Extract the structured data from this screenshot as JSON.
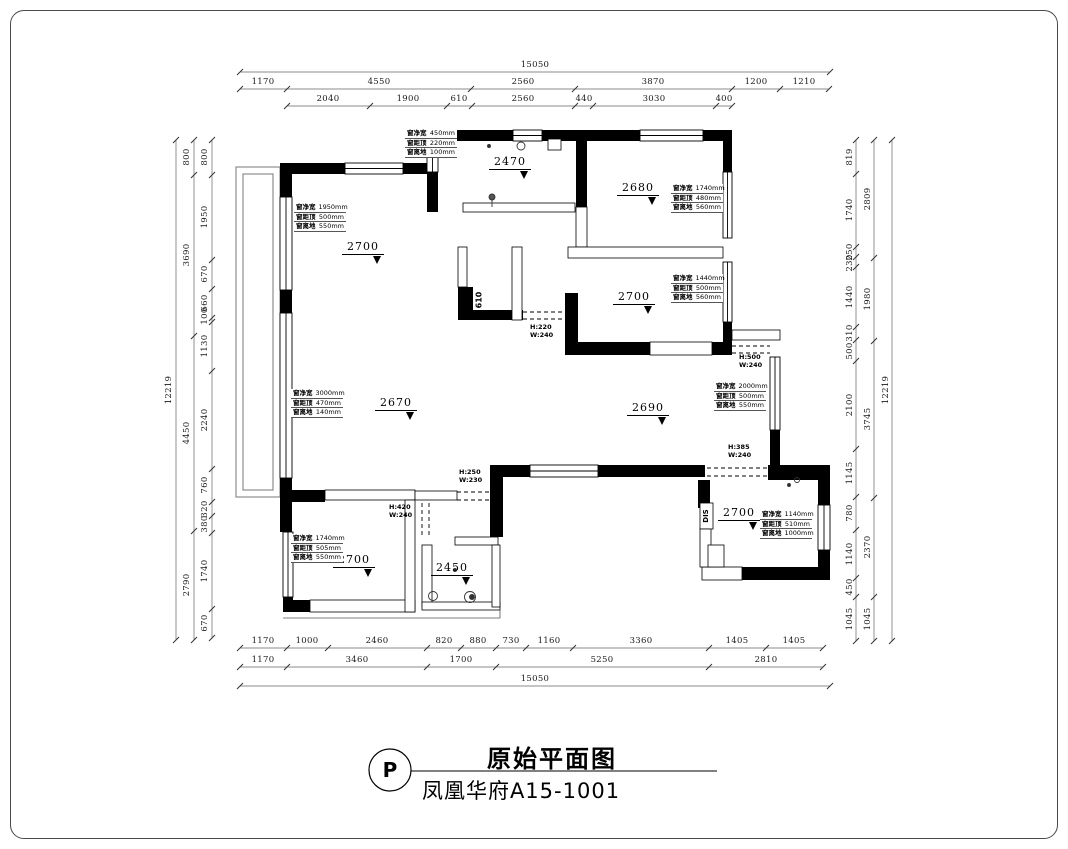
{
  "title_block": {
    "marker": "P",
    "title": "原始平面图",
    "subtitle": "凤凰华府A15-1001"
  },
  "dims": {
    "top": {
      "row1": [
        "15050"
      ],
      "row2": [
        "1170",
        "4550",
        "2560",
        "3870",
        "1200",
        "1210"
      ],
      "row3": [
        "2040",
        "1900",
        "610",
        "2560",
        "440",
        "3030",
        "400"
      ]
    },
    "bottom": {
      "row1": [
        "1170",
        "1000",
        "2460",
        "820",
        "880",
        "730",
        "1160",
        "3360",
        "1405",
        "1405"
      ],
      "row2": [
        "1170",
        "3460",
        "1700",
        "5250",
        "2810"
      ],
      "row3": [
        "15050"
      ]
    },
    "left": {
      "inner": [
        "800",
        "1950",
        "670",
        "660",
        "100",
        "1130",
        "2240",
        "760",
        "320",
        "380",
        "1740",
        "670"
      ],
      "middle": [
        "800",
        "3690",
        "4450",
        "2790"
      ],
      "outer": [
        "12219"
      ]
    },
    "right": {
      "inner": [
        "819",
        "1740",
        "250",
        "230",
        "1440",
        "310",
        "500",
        "2100",
        "1145",
        "780",
        "1140",
        "450",
        "1045"
      ],
      "middle": [
        "2809",
        "1980",
        "3745",
        "2370",
        "1045"
      ],
      "outer": [
        "12219"
      ]
    }
  },
  "levels": [
    "2470",
    "2700",
    "2680",
    "2700",
    "2670",
    "2690",
    "2700",
    "2450",
    "2700"
  ],
  "window_annotations": [
    {
      "rows": [
        {
          "label": "窗净宽",
          "value": "450mm"
        },
        {
          "label": "窗距顶",
          "value": "220mm"
        },
        {
          "label": "窗离地",
          "value": "100mm"
        }
      ]
    },
    {
      "rows": [
        {
          "label": "窗净宽",
          "value": "1950mm"
        },
        {
          "label": "窗距顶",
          "value": "500mm"
        },
        {
          "label": "窗离地",
          "value": "550mm"
        }
      ]
    },
    {
      "rows": [
        {
          "label": "窗净宽",
          "value": "1740mm"
        },
        {
          "label": "窗距顶",
          "value": "480mm"
        },
        {
          "label": "窗离地",
          "value": "560mm"
        }
      ]
    },
    {
      "rows": [
        {
          "label": "窗净宽",
          "value": "1440mm"
        },
        {
          "label": "窗距顶",
          "value": "500mm"
        },
        {
          "label": "窗离地",
          "value": "560mm"
        }
      ]
    },
    {
      "rows": [
        {
          "label": "窗净宽",
          "value": "2000mm"
        },
        {
          "label": "窗距顶",
          "value": "500mm"
        },
        {
          "label": "窗离地",
          "value": "550mm"
        }
      ]
    },
    {
      "rows": [
        {
          "label": "窗净宽",
          "value": "3000mm"
        },
        {
          "label": "窗距顶",
          "value": "470mm"
        },
        {
          "label": "窗离地",
          "value": "140mm"
        }
      ]
    },
    {
      "rows": [
        {
          "label": "窗净宽",
          "value": "1740mm"
        },
        {
          "label": "窗距顶",
          "value": "505mm"
        },
        {
          "label": "窗离地",
          "value": "550mm"
        }
      ]
    },
    {
      "rows": [
        {
          "label": "窗净宽",
          "value": "1140mm"
        },
        {
          "label": "窗距顶",
          "value": "510mm"
        },
        {
          "label": "窗离地",
          "value": "1000mm"
        }
      ]
    }
  ],
  "beams": [
    {
      "h": "H:220",
      "w": "W:240"
    },
    {
      "h": "H:500",
      "w": "W:240"
    },
    {
      "h": "H:385",
      "w": "W:240"
    },
    {
      "h": "H:250",
      "w": "W:230"
    },
    {
      "h": "H:420",
      "w": "W:240"
    }
  ],
  "vertical_labels": {
    "shaft": "610",
    "dis": "DIS"
  },
  "colors": {
    "wall": "#000000",
    "line": "#444444",
    "text": "#1a1a1a"
  }
}
